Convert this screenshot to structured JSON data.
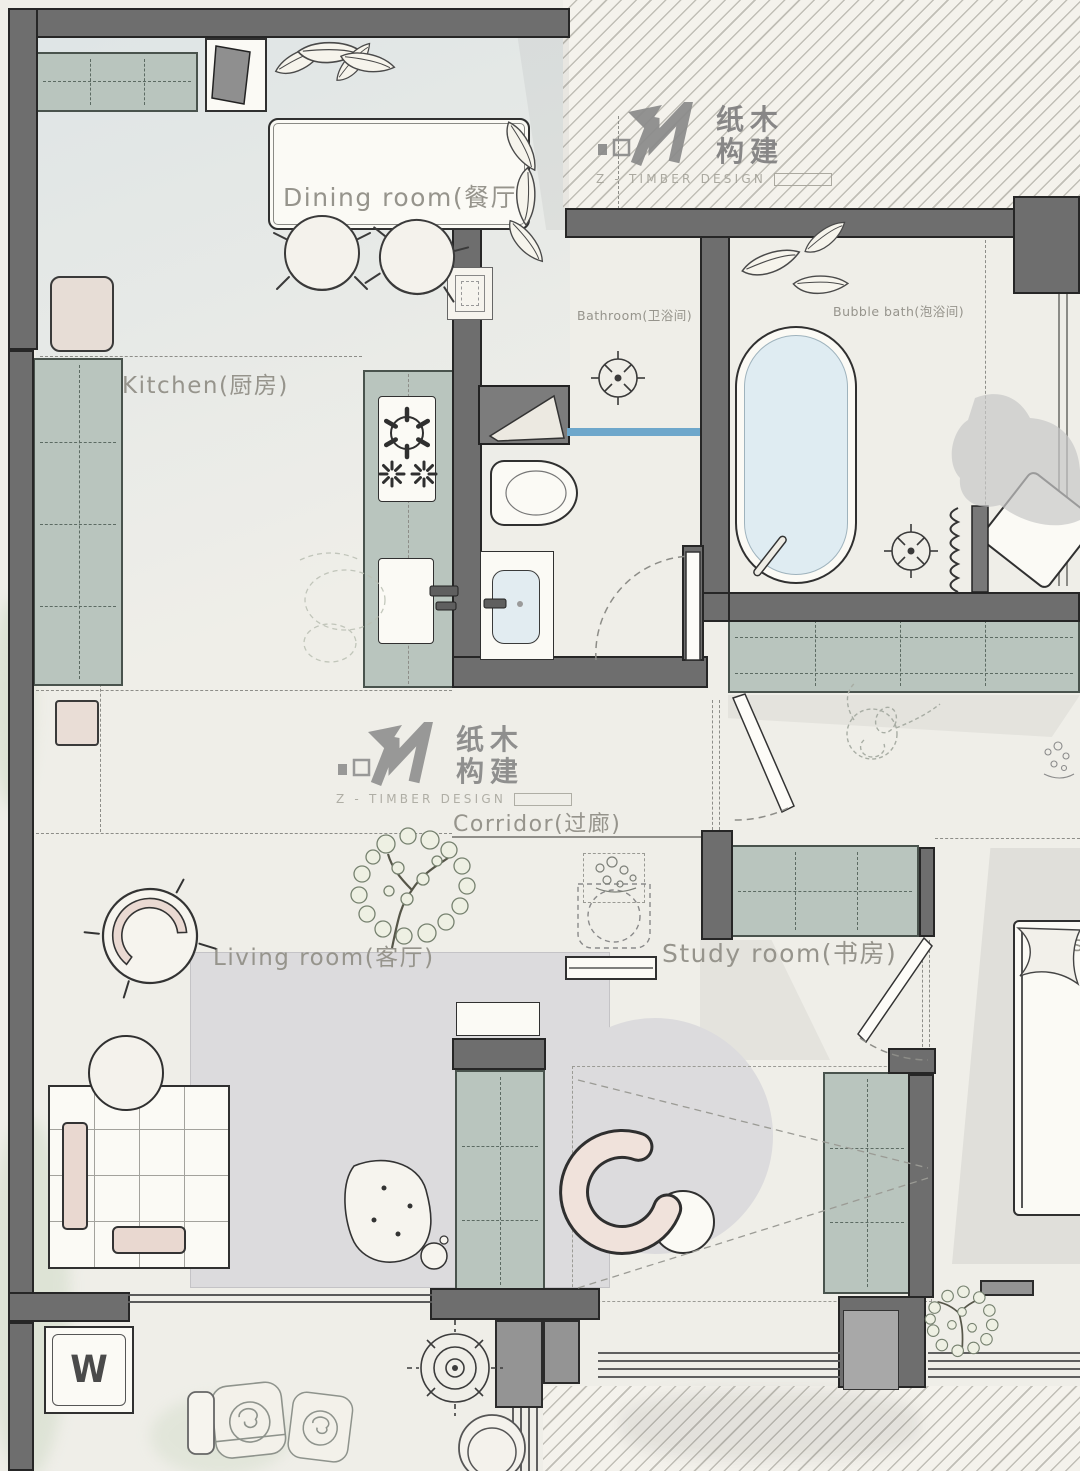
{
  "brand": {
    "zh": [
      "纸木",
      "构建"
    ],
    "en": "Z - TIMBER DESIGN"
  },
  "rooms": {
    "dining": "Dining room(餐厅)",
    "kitchen": "Kitchen(厨房)",
    "bathroom": "Bathroom(卫浴间)",
    "bubble_bath": "Bubble bath(泡浴间)",
    "corridor": "Corridor(过廊)",
    "living": "Living room(客厅)",
    "study": "Study room(书房)",
    "master": "Mast"
  },
  "marks": {
    "washer": "W"
  },
  "colors": {
    "wall": "#6e6e6e",
    "cabinet": "#b9c5be",
    "tub_water": "#dfecf2",
    "glass_partition": "#6ea7cb",
    "pink_accent": "#e9d8d0",
    "rug": "#dcdbdd",
    "label_text": "#96948c"
  }
}
